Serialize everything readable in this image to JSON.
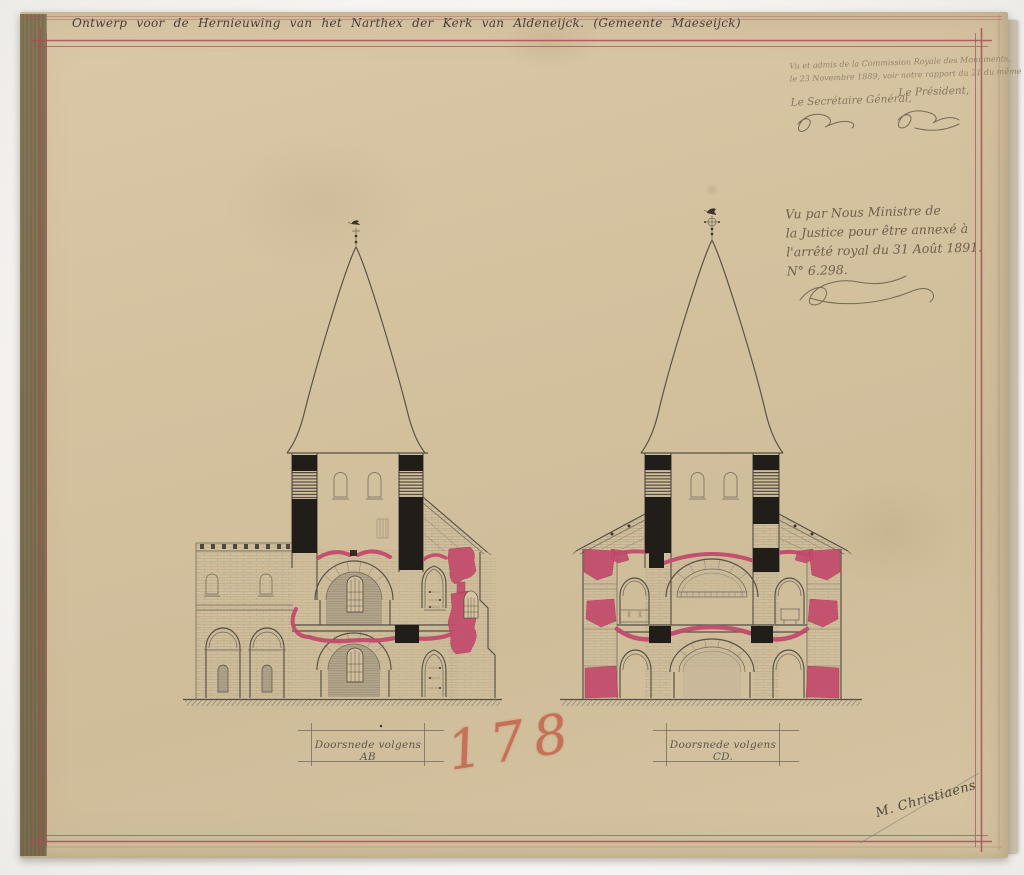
{
  "sheet": {
    "title": "Ontwerp voor de Hernieuwing van het Narthex der Kerk van Aldeneijck. (Gemeente Maeseijck)",
    "drawing_number": "178",
    "architect_signature": "M. Christiaens"
  },
  "stamps": {
    "commission_note": {
      "line1": "Vu et admis de la Commission Royale des Monuments,",
      "line2": "le 23 Novembre 1889, voir notre rapport du 21 du même mois, N° 5412.",
      "secretary_label": "Le Secrétaire Général,",
      "president_label": "Le Président,"
    },
    "ministerial_note": {
      "line1": "Vu par Nous Ministre de",
      "line2": "la Justice pour être annexé à",
      "line3": "l'arrêté royal du 31 Août 1891.",
      "line4": "N° 6.298."
    }
  },
  "sections": [
    {
      "id": "AB",
      "label": "Doorsnede volgens AB"
    },
    {
      "id": "CD",
      "label": "Doorsnede volgens CD."
    }
  ],
  "colors": {
    "paper": "#d6c3a0",
    "border-red": "#a34f58",
    "highlight-pink": "#c24a6b",
    "ink-black": "#211e1a",
    "line-gray": "#6f6a5e",
    "crayon-red": "#c25c45",
    "handwriting": "#7c6d57"
  }
}
